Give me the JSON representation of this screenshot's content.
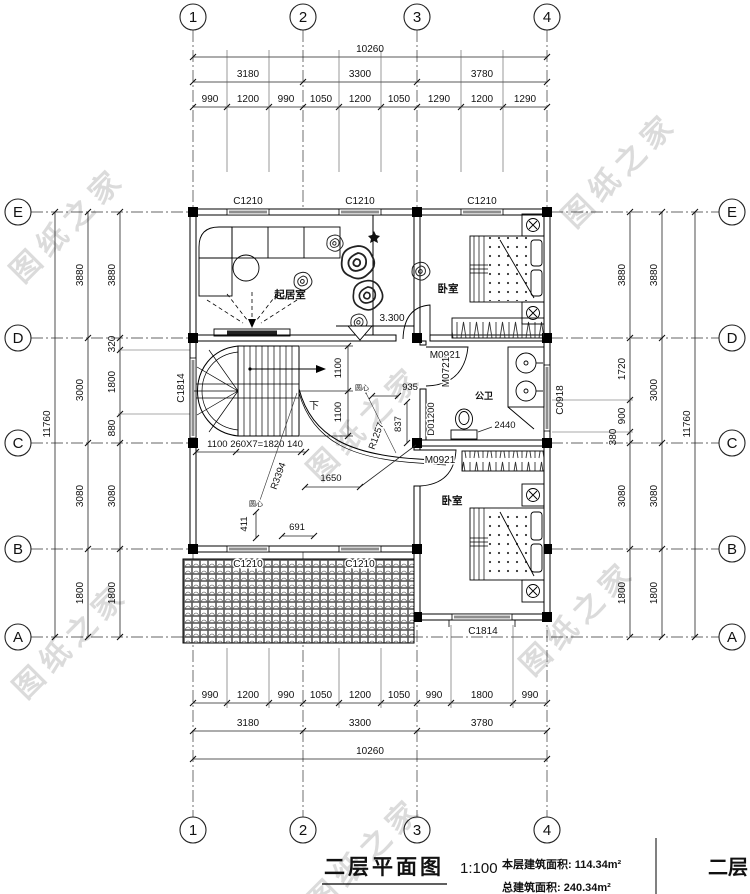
{
  "watermark": {
    "text": "图纸之家"
  },
  "grid": {
    "cols": [
      "1",
      "2",
      "3",
      "4"
    ],
    "rows": [
      "E",
      "D",
      "C",
      "B",
      "A"
    ]
  },
  "dims": {
    "top_total": "10260",
    "top_spans": [
      "3180",
      "3300",
      "3780"
    ],
    "top_detail": [
      "990",
      "1200",
      "990",
      "1050",
      "1200",
      "1050",
      "1290",
      "1200",
      "1290"
    ],
    "bottom_detail": [
      "990",
      "1200",
      "990",
      "1050",
      "1200",
      "1050",
      "990",
      "1800",
      "990"
    ],
    "bottom_spans": [
      "3180",
      "3300",
      "3780"
    ],
    "bottom_total": "10260",
    "left_total": "11760",
    "left_spans": [
      "3880",
      "3000",
      "3080",
      "1800"
    ],
    "left_detail": [
      "3880",
      "320",
      "1800",
      "880",
      "3080",
      "1800"
    ],
    "right_detail": [
      "3880",
      "1720",
      "900",
      "380",
      "3080",
      "1800"
    ],
    "right_spans": [
      "3880",
      "3000",
      "3080",
      "1800"
    ],
    "right_total": "11760"
  },
  "windows": {
    "c1210": "C1210",
    "c1814": "C1814",
    "c0918": "C0918"
  },
  "doors": {
    "m0921": "M0921",
    "m0721": "M0721"
  },
  "rooms": {
    "living": "起居室",
    "bedroom_top": "卧室",
    "bath": "公卫",
    "bedroom_bottom": "卧室"
  },
  "annotations": {
    "level": "3.300",
    "down": "下",
    "stair_width": "1100",
    "stair_run": "1100 260X7=1820 140",
    "dim935": "935",
    "dim837": "837",
    "r1257": "R1257",
    "d01200": "D01200",
    "dim2440": "2440",
    "center_mark": "圆心",
    "r3394": "R3394",
    "dim411": "411",
    "dim691": "691",
    "dim1650": "1650"
  },
  "titleblock": {
    "title": "二层平面图",
    "scale": "1:100",
    "area_line1": "本层建筑面积: 114.34m²",
    "area_line2": "总建筑面积: 240.34m²",
    "panel": "二层"
  }
}
